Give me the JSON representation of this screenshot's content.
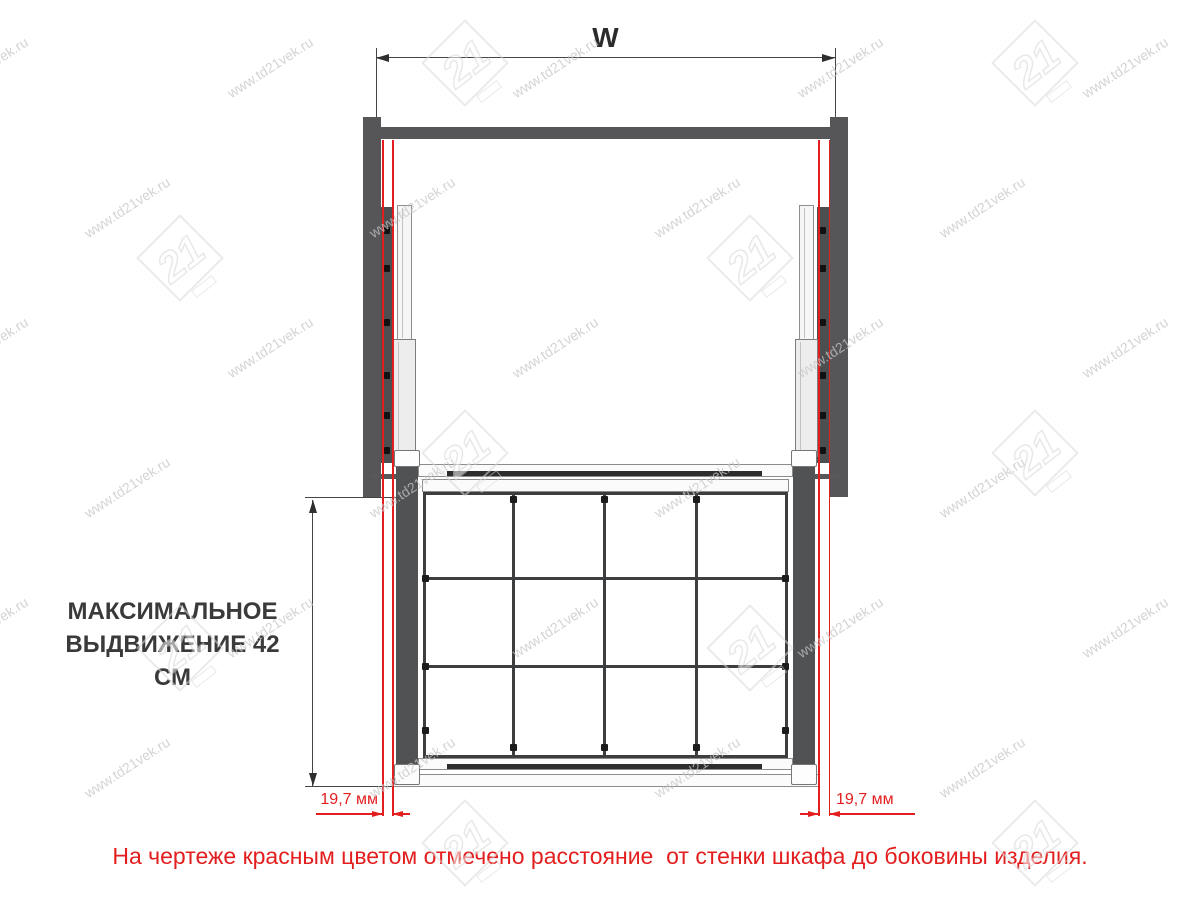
{
  "note": {
    "text": "На чертеже красным цветом отмечено расстояние  от стенки шкафа до боковины изделия."
  },
  "dims": {
    "w": "W",
    "ext1": "МАКСИМАЛЬНОЕ",
    "ext2": "ВЫДВИЖЕНИЕ 42 СМ",
    "gap_left": "19,7 мм",
    "gap_right": "19,7 мм"
  },
  "watermark": {
    "text": "www.td21vek.ru",
    "logo_text": "21"
  },
  "colors": {
    "red": "#e31e1e",
    "panel": "#565658",
    "prodpanel": "#515254",
    "wire": "#3d3e40",
    "dim": "#454545",
    "watermark": "#c6c6c6"
  }
}
